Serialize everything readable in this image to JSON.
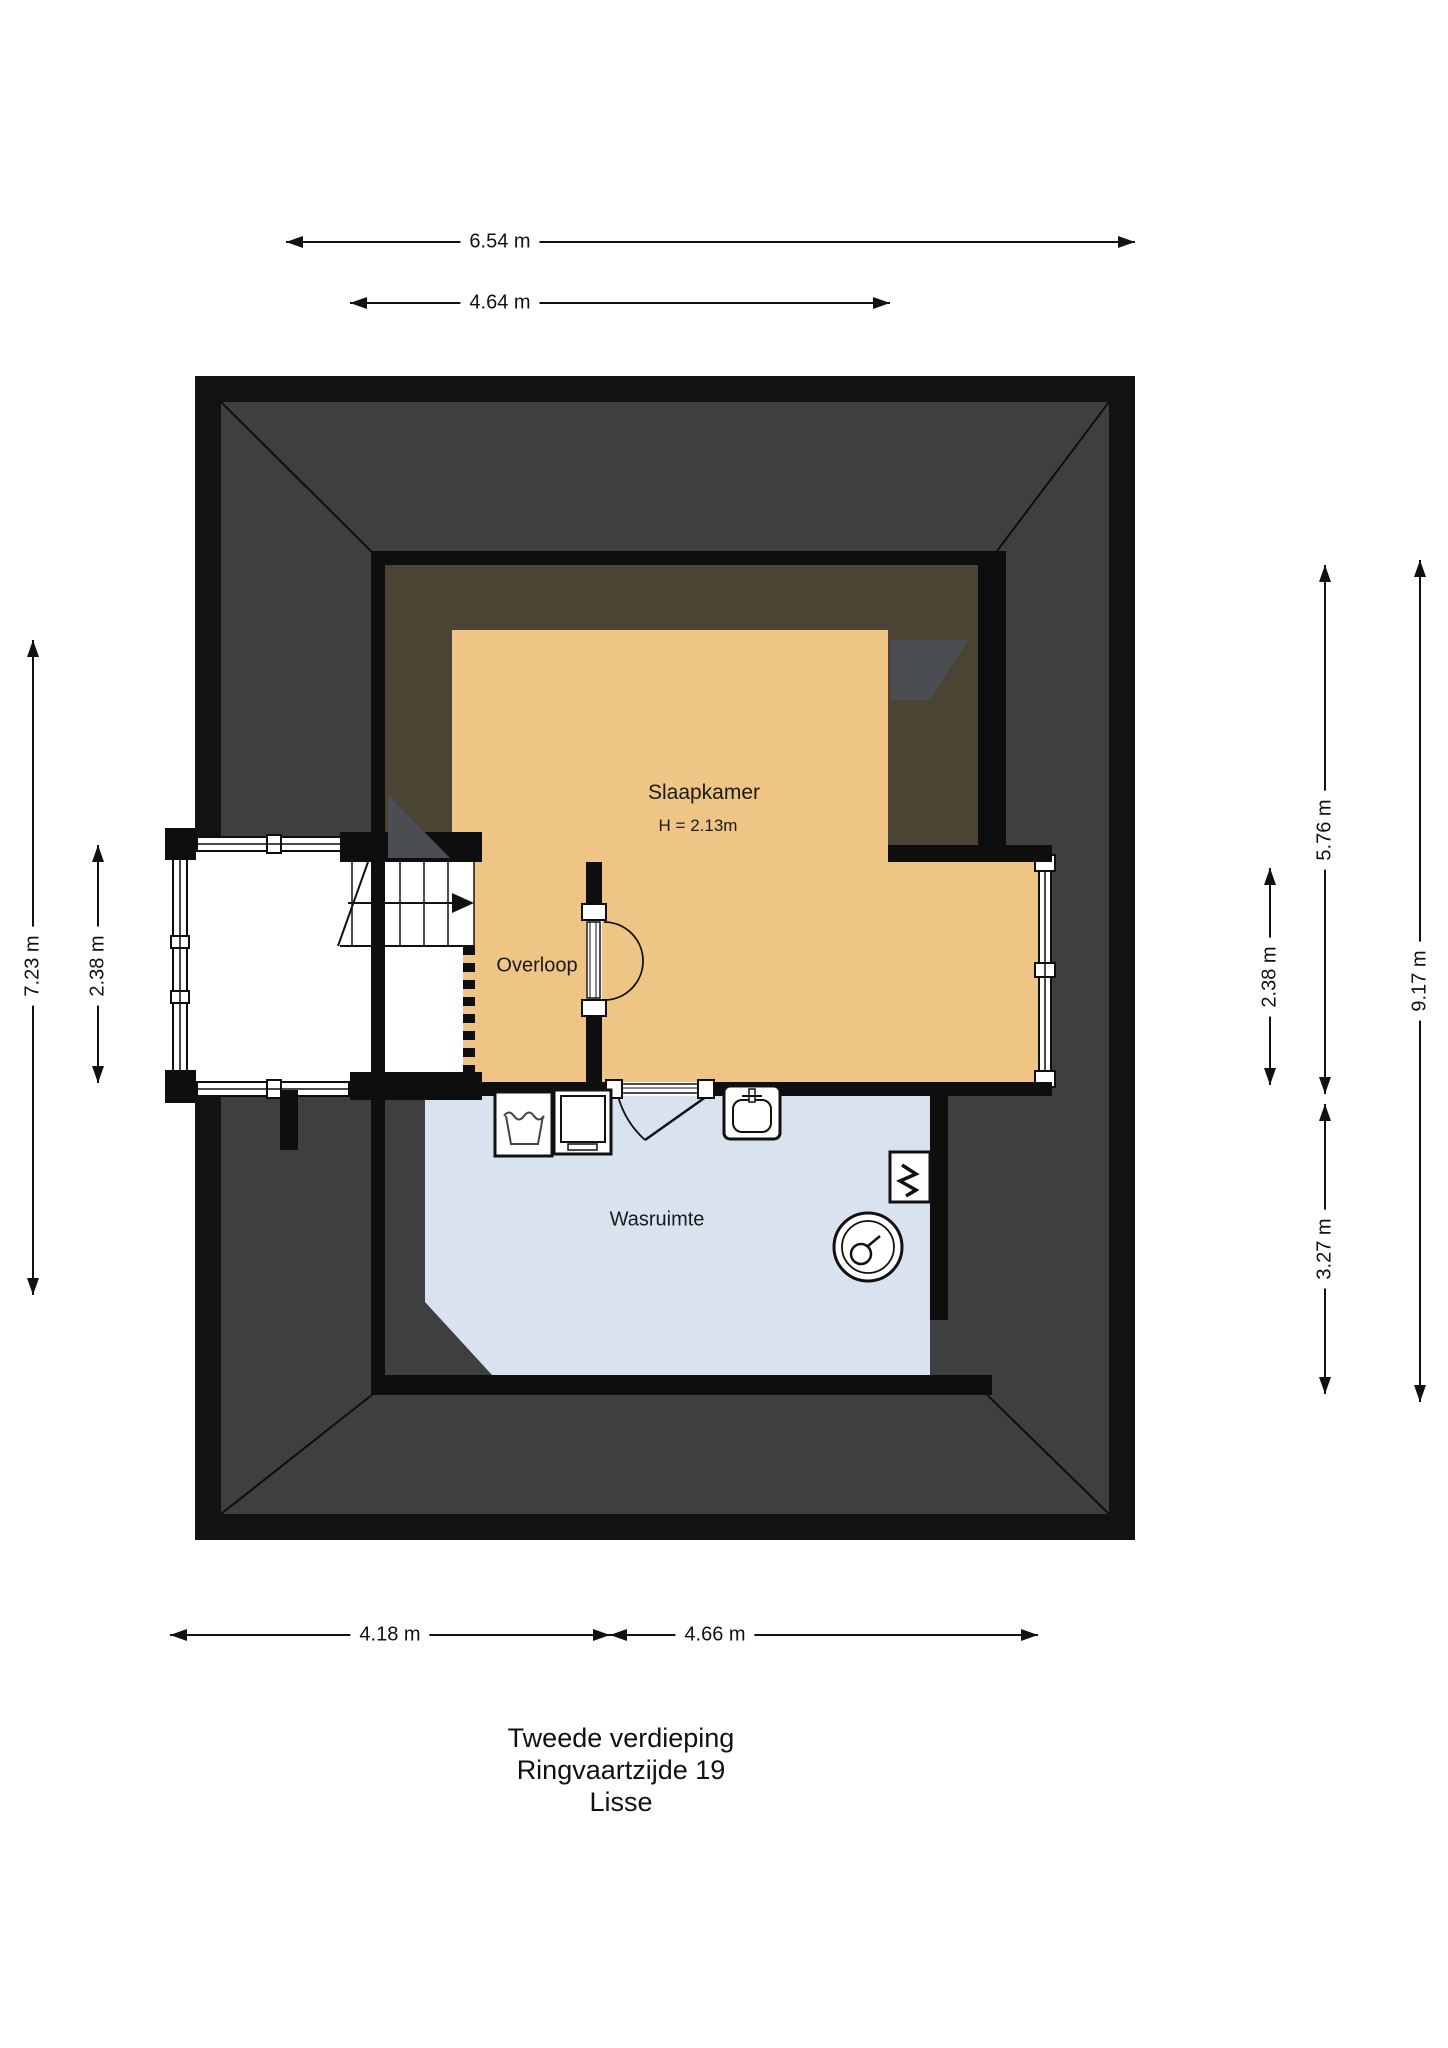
{
  "floorplan": {
    "title_lines": {
      "floor": "Tweede verdieping",
      "address": "Ringvaartzijde 19",
      "city": "Lisse"
    },
    "rooms": {
      "slaapkamer": {
        "label": "Slaapkamer",
        "height_note": "H = 2.13m"
      },
      "overloop": {
        "label": "Overloop"
      },
      "wasruimte": {
        "label": "Wasruimte"
      }
    },
    "dimensions": {
      "top": [
        "6.54 m",
        "4.64 m"
      ],
      "left": [
        "7.23 m",
        "2.38 m"
      ],
      "right": [
        "2.38 m",
        "5.76 m",
        "3.27 m",
        "9.17 m"
      ],
      "bottom": [
        "4.18 m",
        "4.66 m"
      ]
    },
    "icons": {
      "stairs_arrow": "stairs-direction-arrow",
      "door": "door-swing-arc",
      "washer": "washing-machine",
      "dryer": "dryer",
      "sink": "washbasin",
      "boiler": "boiler-tank",
      "heater": "water-heater"
    },
    "colors": {
      "roof": "#3e3f41",
      "roof_edge": "#121212",
      "wall": "#0e0e0e",
      "low_ceiling_zone": "#4b4334",
      "roof_plane_accent": "#4a4e53",
      "room_orange": "#eec584",
      "room_blue": "#d8e3ef"
    }
  }
}
